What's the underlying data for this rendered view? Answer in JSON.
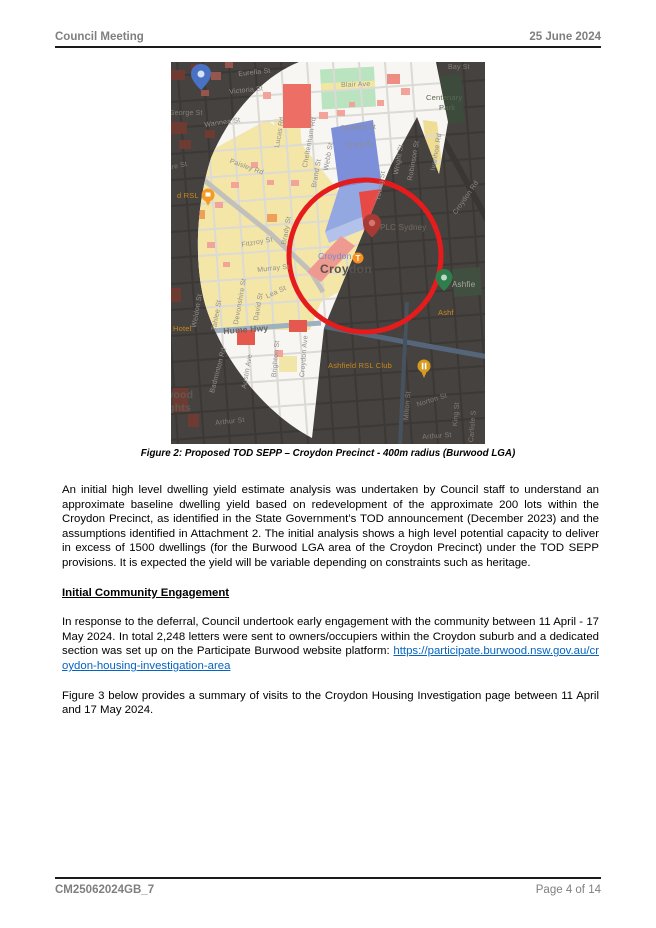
{
  "header": {
    "title": "Council Meeting",
    "date": "25 June 2024"
  },
  "footer": {
    "doc_id": "CM25062024GB_7",
    "page": "Page 4 of 14"
  },
  "figure": {
    "caption": "Figure 2: Proposed TOD SEPP – Croydon Precinct - 400m radius (Burwood LGA)",
    "map": {
      "suburb": "Croydon",
      "station_name": "Croydon",
      "station_line_icon": "T",
      "colors": {
        "radius_circle_red": "#e61c1c",
        "dark_overlay": "#46423f",
        "zone_yellow": "#f4e6a6",
        "zone_blue": "#7c8fd8",
        "zone_red": "#e74a45",
        "zone_green": "#b9e4bf",
        "lit_base": "#f8f6f2"
      },
      "labels": [
        {
          "t": "Bay St",
          "x": 277,
          "y": 2,
          "r": 0,
          "c": "dk"
        },
        {
          "t": "Eurella St",
          "x": 67,
          "y": 9,
          "r": -6,
          "c": "st"
        },
        {
          "t": "Victoria St",
          "x": 58,
          "y": 27,
          "r": -6,
          "c": "st"
        },
        {
          "t": "Blair Ave",
          "x": 170,
          "y": 20,
          "r": -2,
          "c": "st"
        },
        {
          "t": "Centenary",
          "x": 255,
          "y": 32,
          "r": 0,
          "c": "park"
        },
        {
          "t": "Park",
          "x": 268,
          "y": 42,
          "r": 0,
          "c": "park"
        },
        {
          "t": "George St",
          "x": -2,
          "y": 48,
          "r": 0,
          "c": "dk"
        },
        {
          "t": "Wannea St",
          "x": 33,
          "y": 60,
          "r": -8,
          "c": "st"
        },
        {
          "t": "Orchard St",
          "x": 169,
          "y": 63,
          "r": -2,
          "c": "st"
        },
        {
          "t": "Irrara St",
          "x": 175,
          "y": 80,
          "r": -2,
          "c": "st"
        },
        {
          "t": "Lucas Rd",
          "x": 103,
          "y": 85,
          "r": -80,
          "c": "st"
        },
        {
          "t": "Cheltenham Rd",
          "x": 131,
          "y": 105,
          "r": -80,
          "c": "st"
        },
        {
          "t": "Webb St",
          "x": 152,
          "y": 108,
          "r": -80,
          "c": "st"
        },
        {
          "t": "Brand St",
          "x": 140,
          "y": 125,
          "r": -80,
          "c": "st"
        },
        {
          "t": "Young St",
          "x": 204,
          "y": 138,
          "r": -80,
          "c": "st"
        },
        {
          "t": "Wright St",
          "x": 222,
          "y": 112,
          "r": -80,
          "c": "st"
        },
        {
          "t": "Robinson St",
          "x": 236,
          "y": 118,
          "r": -80,
          "c": "st"
        },
        {
          "t": "Ivanhoe Rd",
          "x": 259,
          "y": 108,
          "r": -80,
          "c": "st"
        },
        {
          "t": "Croydon Rd",
          "x": 281,
          "y": 150,
          "r": -55,
          "c": "dkroad"
        },
        {
          "t": "Paisley Rd",
          "x": 60,
          "y": 96,
          "r": 20,
          "c": "st"
        },
        {
          "t": "hore St",
          "x": -8,
          "y": 104,
          "r": -12,
          "c": "dk"
        },
        {
          "t": "d RSL",
          "x": 6,
          "y": 130,
          "r": 0,
          "c": "org"
        },
        {
          "t": "Fitzroy St",
          "x": 70,
          "y": 180,
          "r": -10,
          "c": "st"
        },
        {
          "t": "Brady St",
          "x": 110,
          "y": 182,
          "r": -80,
          "c": "st"
        },
        {
          "t": "Murray St",
          "x": 86,
          "y": 205,
          "r": -6,
          "c": "st"
        },
        {
          "t": "Lea St",
          "x": 94,
          "y": 232,
          "r": -25,
          "c": "st"
        },
        {
          "t": "David St",
          "x": 82,
          "y": 258,
          "r": -80,
          "c": "st"
        },
        {
          "t": "Devonshire St",
          "x": 62,
          "y": 262,
          "r": -80,
          "c": "st"
        },
        {
          "t": "Tahlee St",
          "x": 40,
          "y": 268,
          "r": -80,
          "c": "st"
        },
        {
          "t": "Weldon St",
          "x": 20,
          "y": 265,
          "r": -80,
          "c": "st"
        },
        {
          "t": "Hume Hwy",
          "x": 52,
          "y": 265,
          "r": -4,
          "c": "hwy"
        },
        {
          "t": "Hotel",
          "x": 2,
          "y": 263,
          "r": 0,
          "c": "org"
        },
        {
          "t": "Austin Ave",
          "x": 70,
          "y": 326,
          "r": -80,
          "c": "st"
        },
        {
          "t": "Badminton Rd",
          "x": 38,
          "y": 330,
          "r": -75,
          "c": "st"
        },
        {
          "t": "Brighton St",
          "x": 100,
          "y": 315,
          "r": -85,
          "c": "st"
        },
        {
          "t": "Croydon Ave",
          "x": 128,
          "y": 315,
          "r": -85,
          "c": "st"
        },
        {
          "t": "wood",
          "x": -6,
          "y": 328,
          "r": 0,
          "c": "burb"
        },
        {
          "t": "ights",
          "x": -6,
          "y": 341,
          "r": 0,
          "c": "burb"
        },
        {
          "t": "Arthur St",
          "x": 44,
          "y": 358,
          "r": -6,
          "c": "dk"
        },
        {
          "t": "Arthur St",
          "x": 251,
          "y": 372,
          "r": -4,
          "c": "dk"
        },
        {
          "t": "Milton St",
          "x": 232,
          "y": 358,
          "r": -85,
          "c": "dk"
        },
        {
          "t": "Norton St",
          "x": 245,
          "y": 340,
          "r": -18,
          "c": "dk"
        },
        {
          "t": "King St",
          "x": 281,
          "y": 364,
          "r": -85,
          "c": "dk"
        },
        {
          "t": "Carlisle S",
          "x": 297,
          "y": 380,
          "r": -85,
          "c": "dk"
        },
        {
          "t": "Ashfield RSL Club",
          "x": 157,
          "y": 300,
          "r": 0,
          "c": "org"
        },
        {
          "t": "Ashfie",
          "x": 281,
          "y": 219,
          "r": 0,
          "c": "lt"
        },
        {
          "t": "Ashf",
          "x": 267,
          "y": 247,
          "r": 0,
          "c": "org"
        },
        {
          "t": "Croydon",
          "x": 147,
          "y": 190,
          "r": 0,
          "c": "stn"
        },
        {
          "t": "Croydon",
          "x": 149,
          "y": 201,
          "r": 0,
          "c": "sub"
        },
        {
          "t": "PLC Sydney",
          "x": 209,
          "y": 162,
          "r": 0,
          "c": "plc"
        }
      ]
    }
  },
  "body": {
    "para1": "An initial high level dwelling yield estimate analysis was undertaken by Council staff to understand an approximate baseline dwelling yield based on redevelopment of the approximate 200 lots within the Croydon Precinct, as identified in the State Government’s TOD announcement (December 2023) and the assumptions identified in Attachment 2. The initial analysis shows a high level potential capacity to deliver in excess of 1500 dwellings (for the Burwood LGA area of the Croydon Precinct) under the TOD SEPP provisions. It is expected the yield will be variable depending on constraints such as heritage.",
    "heading": "Initial Community Engagement",
    "para2_before_link": "In response to the deferral, Council undertook early engagement with the community between 11 April - 17 May 2024. In total 2,248 letters were sent to owners/occupiers within the Croydon suburb and a dedicated section was set up on the Participate Burwood website platform: ",
    "para2_link": "https://participate.burwood.nsw.gov.au/croydon-housing-investigation-area",
    "para3": "Figure 3 below provides a summary of visits to the Croydon Housing Investigation page between 11 April and 17 May 2024."
  }
}
